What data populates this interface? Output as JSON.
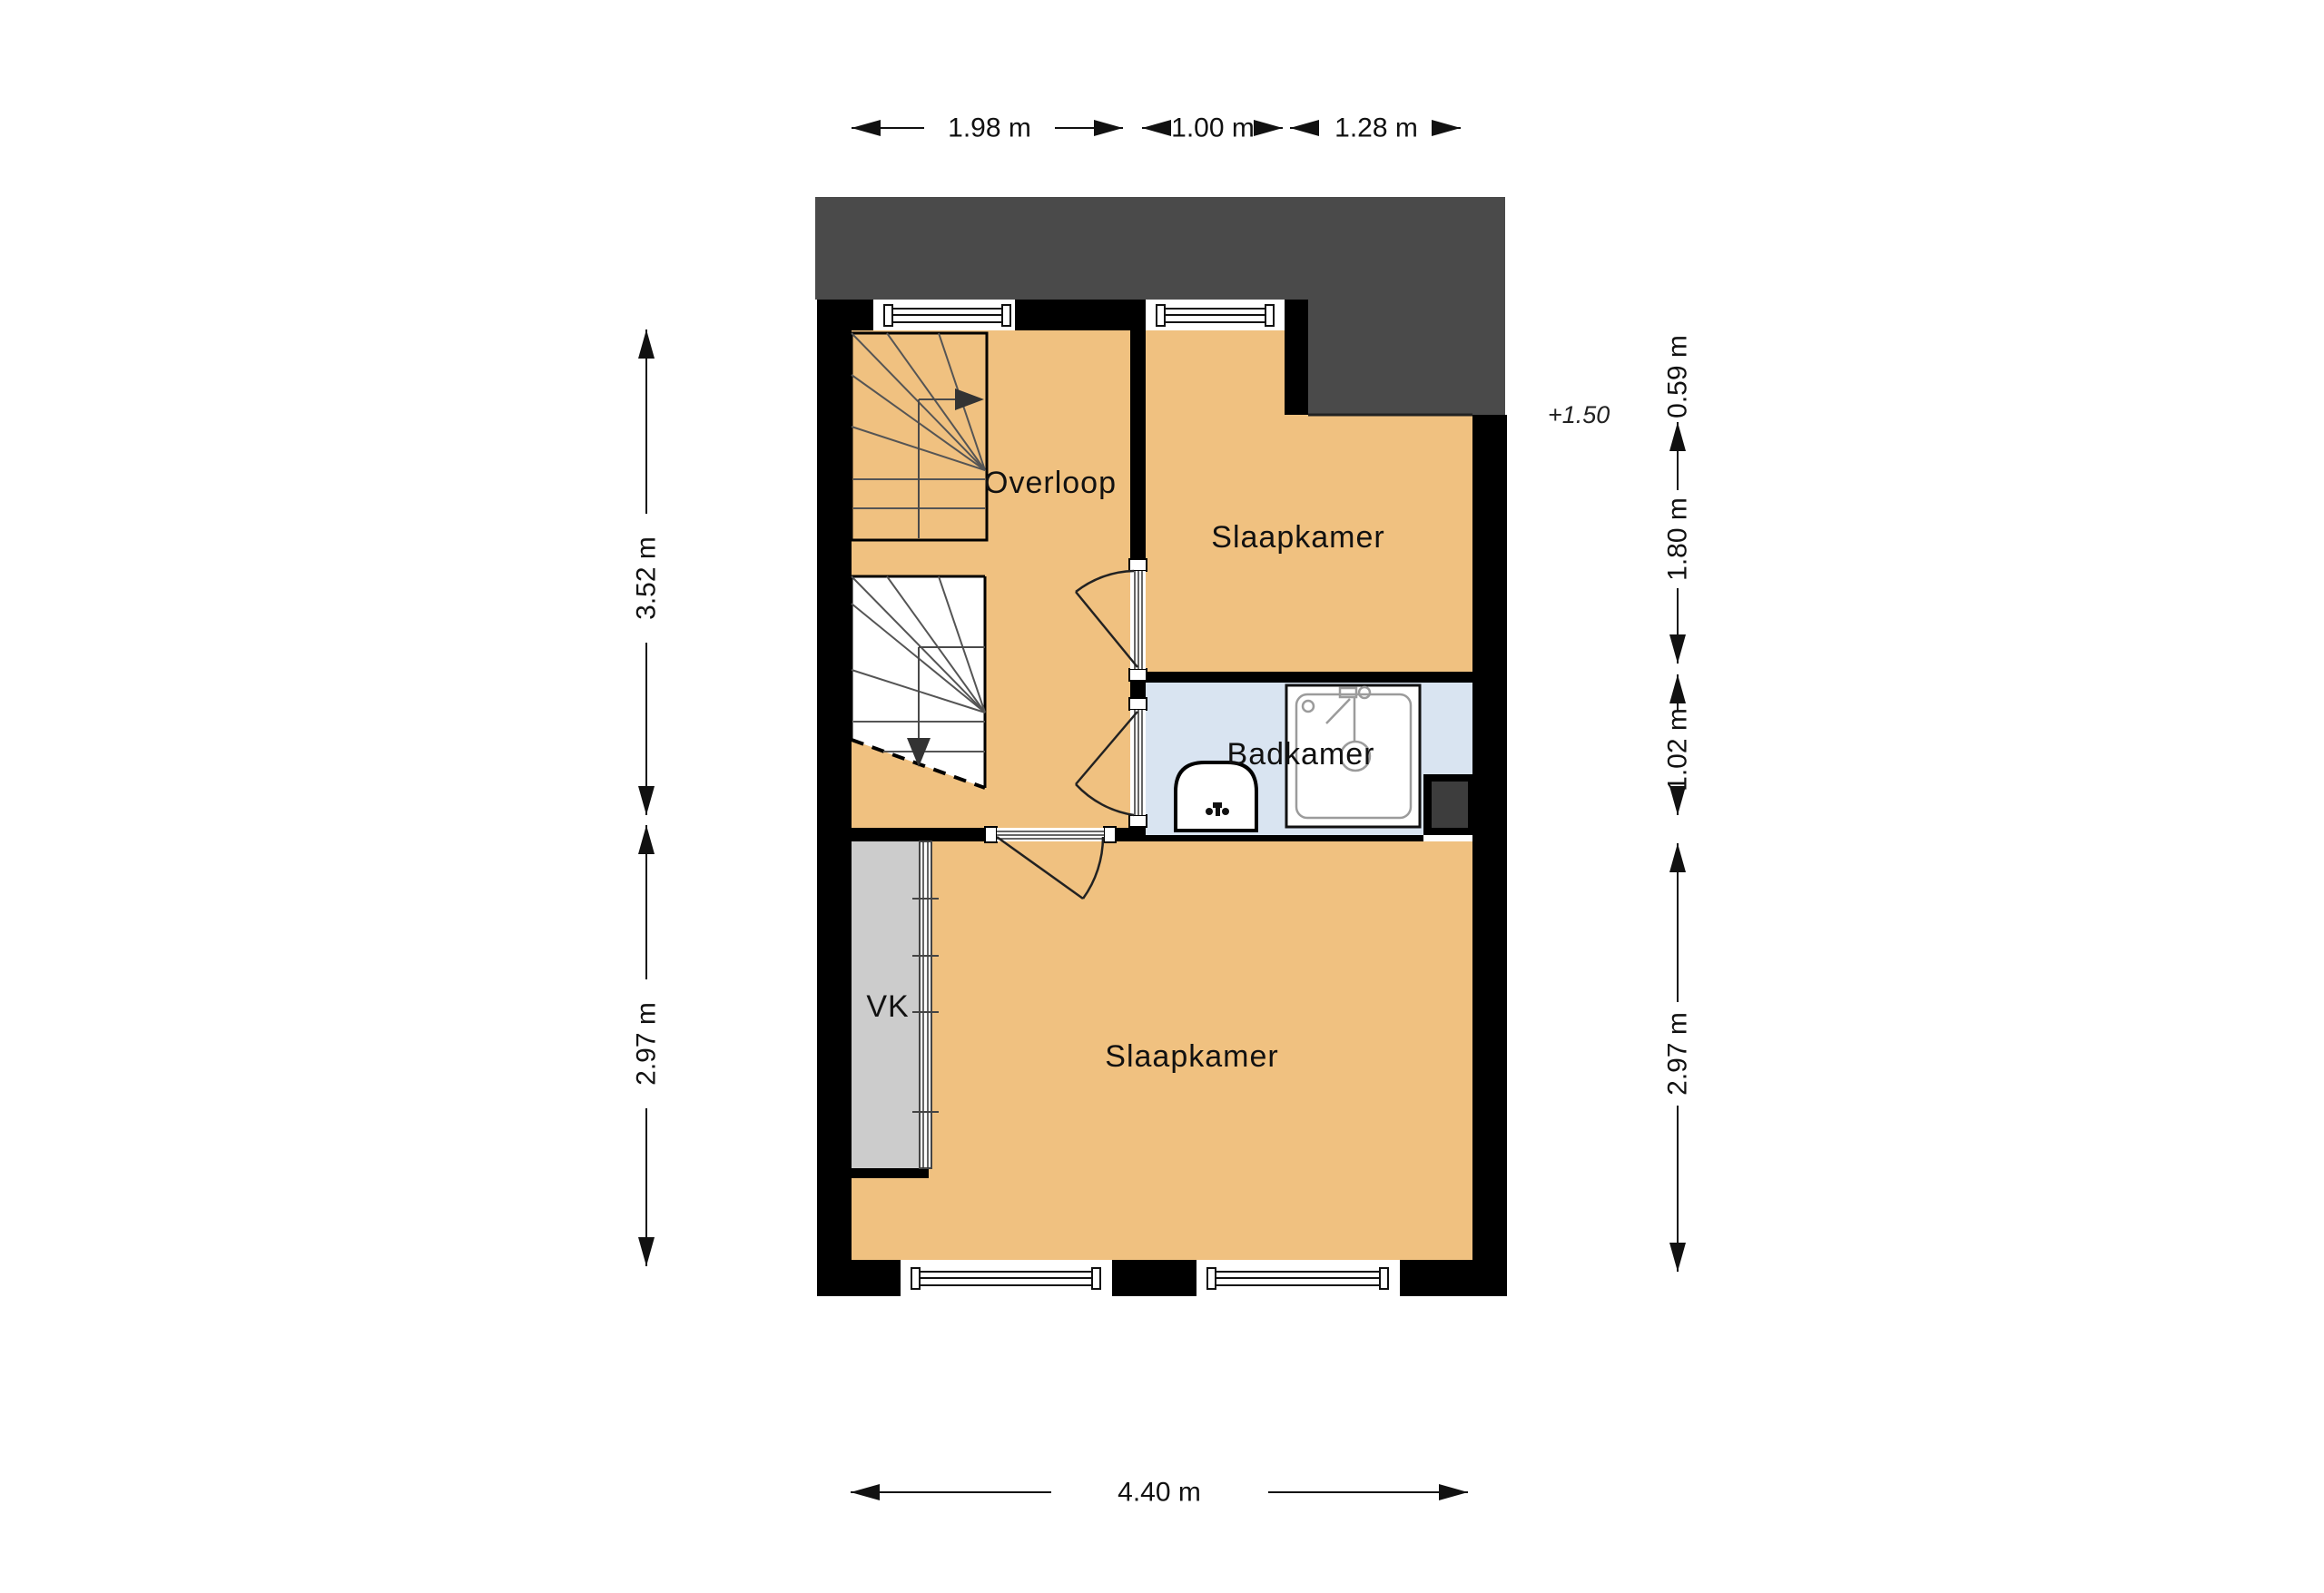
{
  "page": {
    "background": "#ffffff",
    "kind": "floor-plan"
  },
  "colors": {
    "floor_orange": "#f0c180",
    "bathroom_blue": "#d9e4f1",
    "closet_gray": "#cccccc",
    "roof_gray": "#4a4a4a",
    "shaft_gray": "#3d3d3d",
    "wall_black": "#000000"
  },
  "rooms": [
    {
      "label": "Overloop"
    },
    {
      "label": "Slaapkamer"
    },
    {
      "label": "Badkamer"
    },
    {
      "label": "Slaapkamer"
    },
    {
      "label": "VK"
    }
  ],
  "annotations": {
    "level_marker": "+1.50"
  },
  "dimensions": {
    "top": [
      {
        "label": "1.98 m"
      },
      {
        "label": "1.00 m"
      },
      {
        "label": "1.28 m"
      }
    ],
    "left": [
      {
        "label": "3.52 m"
      },
      {
        "label": "2.97 m"
      }
    ],
    "right": [
      {
        "label": "0.59 m"
      },
      {
        "label": "1.80 m"
      },
      {
        "label": "1.02 m"
      },
      {
        "label": "2.97 m"
      }
    ],
    "bottom": [
      {
        "label": "4.40 m"
      }
    ]
  }
}
